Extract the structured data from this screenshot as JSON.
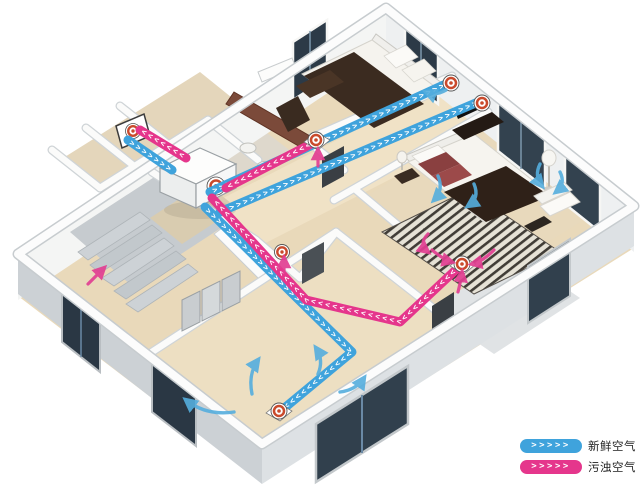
{
  "legend": {
    "chevrons": ">>>>>",
    "items": [
      {
        "id": "fresh-air",
        "label": "新鲜空气",
        "color": "#3fa3dc"
      },
      {
        "id": "polluted-air",
        "label": "污浊空气",
        "color": "#e5368c"
      }
    ]
  },
  "diagram": {
    "type": "ventilation-airflow-isometric-floorplan",
    "duct_chevrons": ">>>>>>>>>>>>>>>>>>>>>>>>>>>>>>>>>>>>>>>>>>>>>>>>>>",
    "colors": {
      "fresh_air": "#3fa3dc",
      "polluted_air": "#e5368c",
      "vent_ring": "#c94a2c"
    }
  }
}
